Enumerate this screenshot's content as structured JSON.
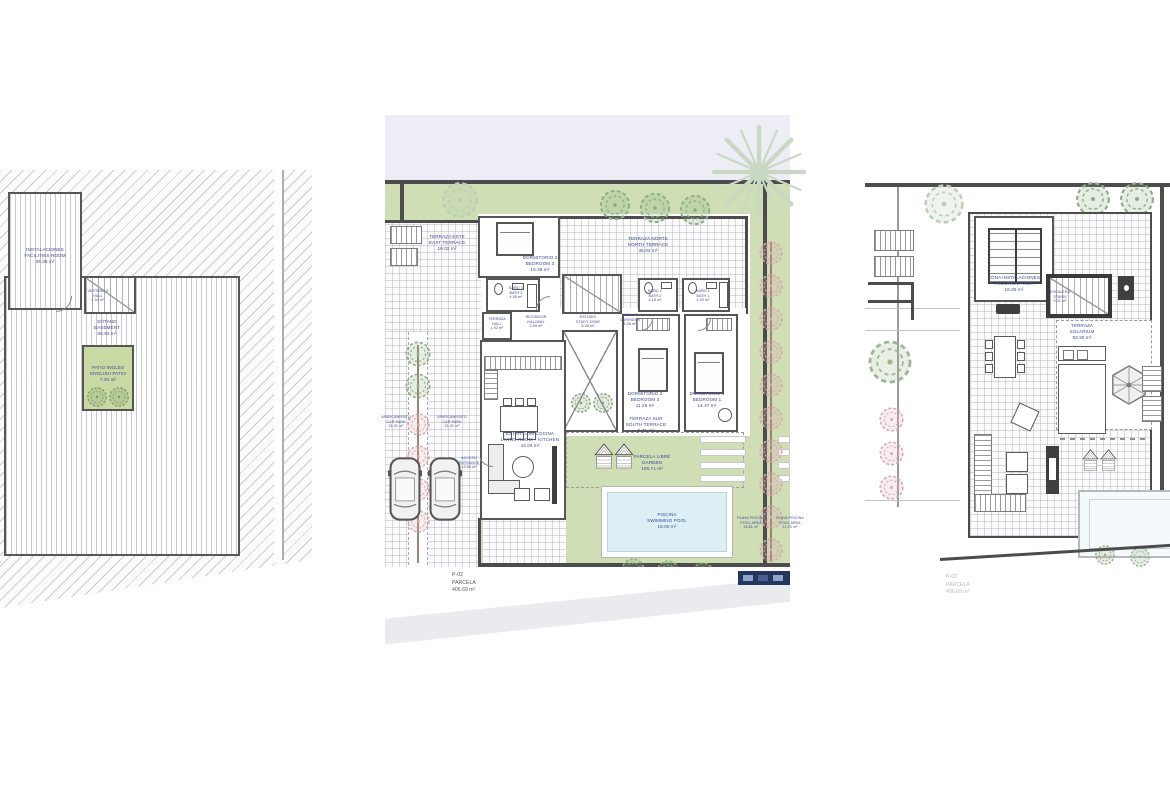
{
  "colors": {
    "wall": "#4c4c4c",
    "garden_green": "#cfdeb4",
    "patio_green": "#c9d9a3",
    "pool_blue": "#dbeff5",
    "label_navy": "#3b4a96",
    "tree_green": "#8fae84",
    "tree_light_green": "#bccfb6",
    "tree_pink": "#d9a8b0",
    "street_band_lavender": "#ededf6",
    "sidewalk_gray": "#e9ebee",
    "legend_navy": "#24365e"
  },
  "basement_plan": {
    "labels": {
      "facilities": {
        "es": "INSTALACIONES",
        "en": "FACILITIES ROOM",
        "area": "35.39 m²"
      },
      "hall": {
        "es": "VESTÍBULO",
        "en": "HALL",
        "area": "1.94 m²"
      },
      "basement": {
        "es": "SÓTANO",
        "en": "BASEMENT",
        "area": "89.93 m²"
      },
      "patio": {
        "es": "PATIO INGLÉS",
        "en": "ENGLISH PATIO",
        "area": "7.20 m²"
      },
      "parcela_partial": "PARCELA"
    }
  },
  "ground_plan": {
    "labels": {
      "terraza_este": {
        "es": "TERRAZA ESTE",
        "en": "EAST TERRACE",
        "area": "18.02 m²"
      },
      "terraza_norte": {
        "es": "TERRAZA NORTE",
        "en": "NORTH TERRACE",
        "area": "35.02 m²"
      },
      "dormitorio3": {
        "es": "DORMITORIO 3",
        "en": "BEDROOM 3",
        "area": "15.38 m²"
      },
      "bano3": {
        "es": "BAÑO 3",
        "en": "BATH 3",
        "area": "4.05 m²"
      },
      "terraza_hall": {
        "es": "TERRAZA",
        "en": "HALL",
        "area": "1.92 m²"
      },
      "recibidor": {
        "es": "RECIBIDOR",
        "en": "HALLWAY",
        "area": "3.59 m²"
      },
      "estudio": {
        "es": "ESTUDIO",
        "en": "STUDY ZONE",
        "area": "6.35 m²"
      },
      "pasillo": {
        "es": "PASILLO",
        "en": "CORRIDOR",
        "area": "5.06 m²"
      },
      "bano2": {
        "es": "BAÑO 2",
        "en": "BATH 2",
        "area": "4.18 m²"
      },
      "bano1": {
        "es": "BAÑO 1",
        "en": "BATH 1",
        "area": "4.09 m²"
      },
      "dormitorio2": {
        "es": "DORMITORIO 2",
        "en": "BEDROOM 2",
        "area": "11.25 m²"
      },
      "dormitorio1": {
        "es": "DORMITORIO 1",
        "en": "BEDROOM 1",
        "area": "14.47 m²"
      },
      "estar": {
        "es": "ESTAR-COM-COCINA",
        "en": "LIVING ROOM + KITCHEN",
        "area": "43.04 m²"
      },
      "aparcamiento1": {
        "es": "APARCAMIENTO",
        "en": "CAR PARK",
        "area": "21.21 m²"
      },
      "aparcamiento2": {
        "es": "APARCAMIENTO",
        "en": "CAR PARK",
        "area": "21.21 m²"
      },
      "acceso": {
        "es": "ACCESO",
        "en": "ENTRANCE",
        "area": "14.56 m²"
      },
      "terraza_sur": {
        "es": "TERRAZA SUR",
        "en": "SOUTH TERRACE",
        "area": "9.71 m²"
      },
      "parcela_libre": {
        "es": "PARCELA LIBRE",
        "en": "GARDEN",
        "area": "106.71 m²"
      },
      "piscina": {
        "es": "PISCINA",
        "en": "SWIMMING POOL",
        "area": "18.00 m²"
      },
      "playa1": {
        "es": "PLAYA PISCINA",
        "en": "POOL AREA",
        "area": "15.61 m²"
      },
      "playa2": {
        "es": "PLAYA PISCINA",
        "en": "POOL AREA",
        "area": "11.23 m²"
      },
      "parcela": {
        "code": "P-02",
        "name": "PARCELA",
        "area": "406.69 m²"
      }
    }
  },
  "roof_plan": {
    "labels": {
      "zona_instalaciones": {
        "es": "ZONA INSTALACIONES",
        "en": "FACILITIES AREA",
        "area": "16.05 m²"
      },
      "escalera": {
        "es": "ESCALERA",
        "en": "STAIRS",
        "area": "9.31 m²"
      },
      "solarium": {
        "es": "TERRAZA",
        "en": "SOLARIUM",
        "area": "93.90 m²"
      },
      "parcela": {
        "code": "P-02",
        "name": "PARCELA",
        "area": "406.69 m²"
      }
    }
  }
}
